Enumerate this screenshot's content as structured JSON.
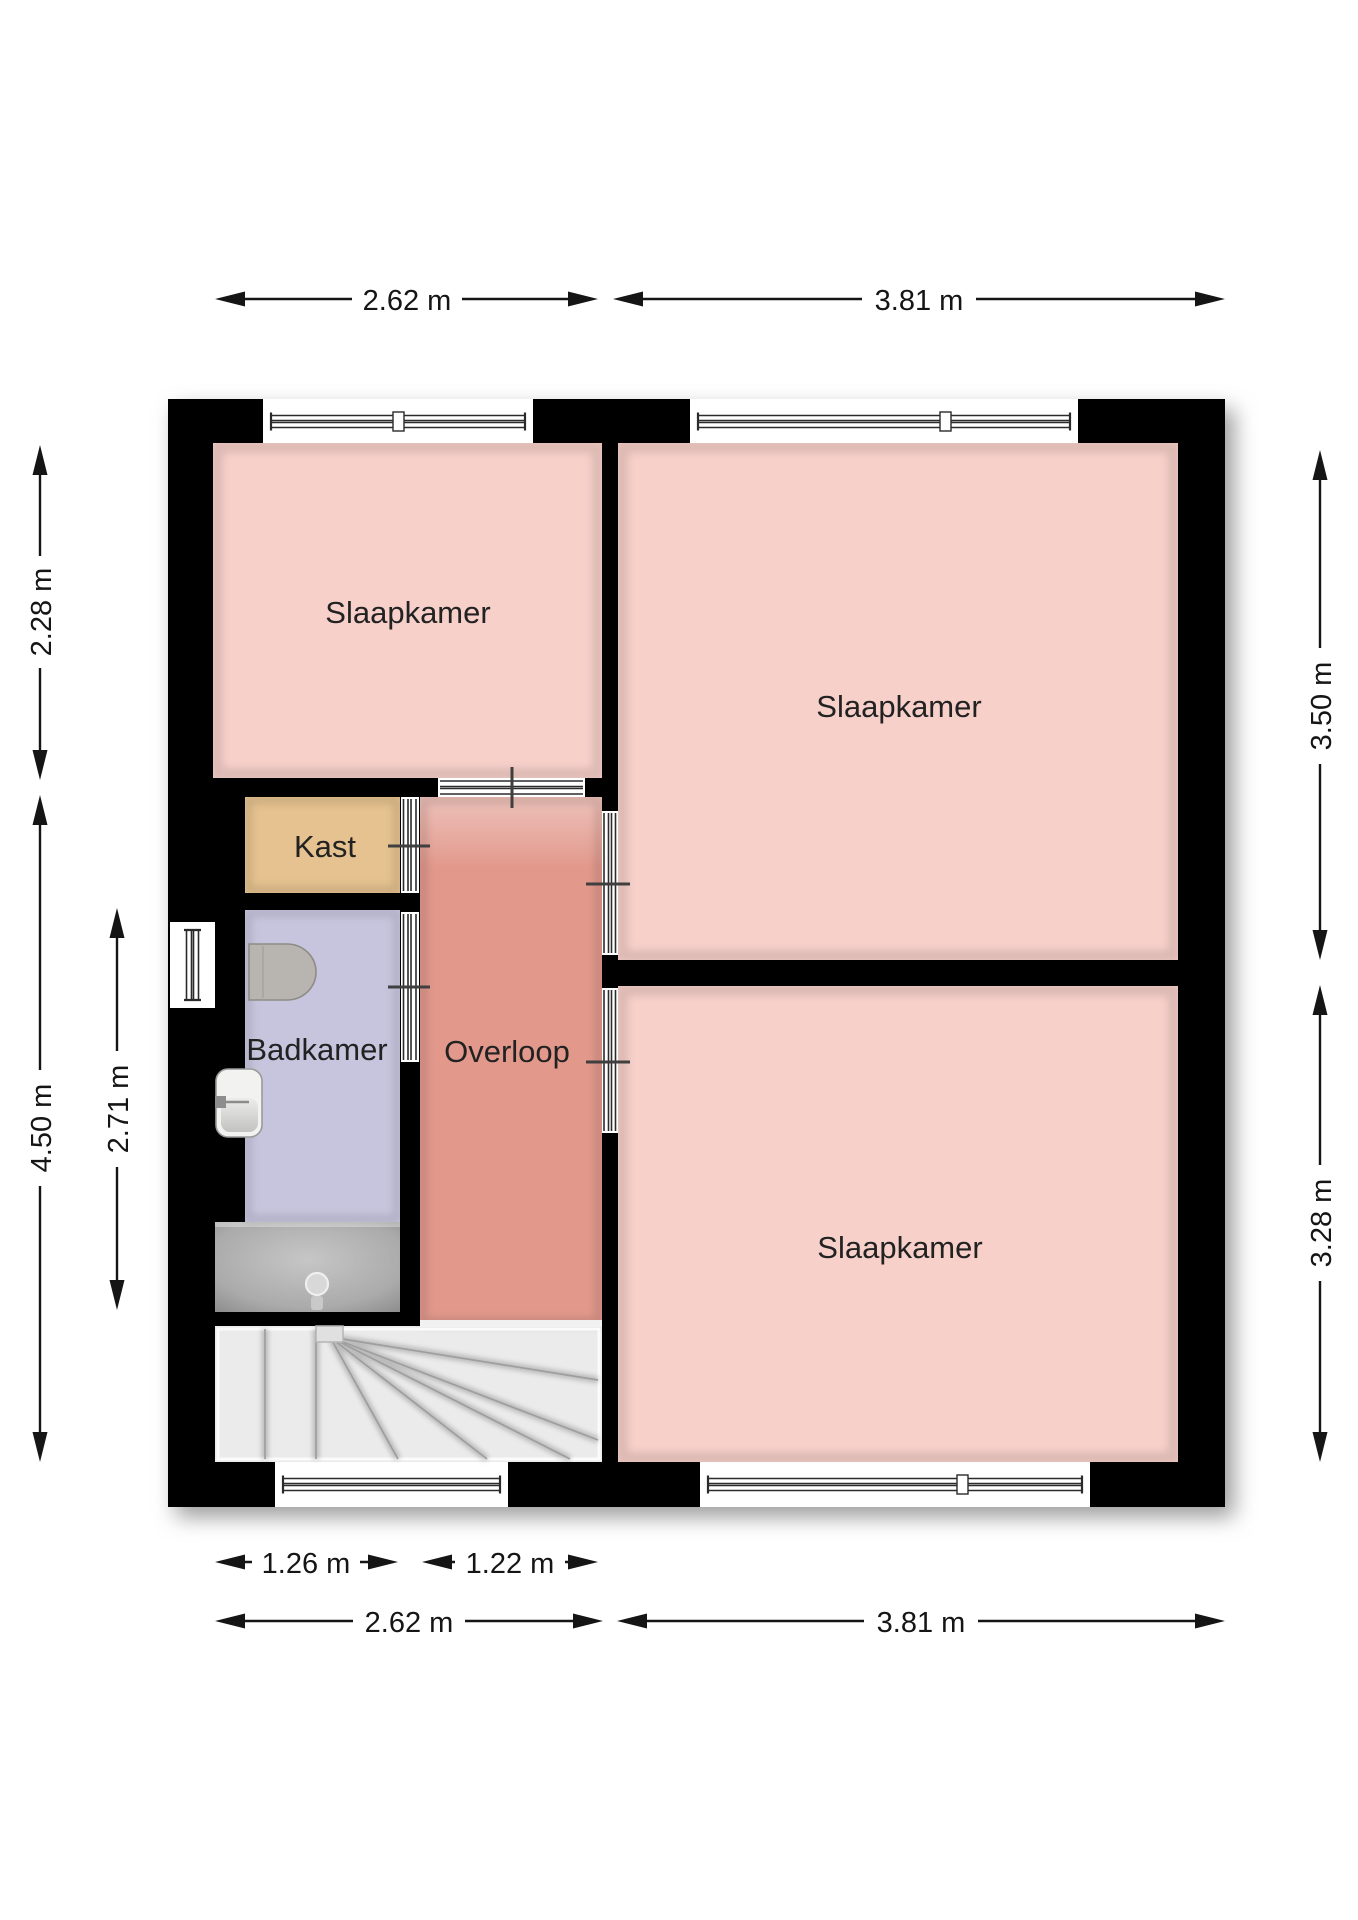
{
  "title": "Verdieping plattegrond",
  "colors": {
    "wall": "#000000",
    "bedroom": "#f8d0ca",
    "hallway": "#e2998c",
    "closet": "#e5c28f",
    "bathroom": "#c7c5dd",
    "stairs": "#ebebeb",
    "shower": "#ababab",
    "background": "#ffffff",
    "dimension_text": "#151515"
  },
  "rooms": [
    {
      "id": "slaapkamer-top-left",
      "label": "Slaapkamer"
    },
    {
      "id": "slaapkamer-top-right",
      "label": "Slaapkamer"
    },
    {
      "id": "slaapkamer-bottom-right",
      "label": "Slaapkamer"
    },
    {
      "id": "kast",
      "label": "Kast"
    },
    {
      "id": "badkamer",
      "label": "Badkamer"
    },
    {
      "id": "overloop",
      "label": "Overloop"
    }
  ],
  "fixtures": [
    "toilet",
    "washbasin",
    "shower-head",
    "staircase",
    "window",
    "door-opening"
  ],
  "dimensions": {
    "top_left": "2.62 m",
    "top_right": "3.81 m",
    "left_upper": "2.28 m",
    "left_full": "4.50 m",
    "left_inner": "2.71 m",
    "right_upper": "3.50 m",
    "right_lower": "3.28 m",
    "bottom_inner_left": "1.26 m",
    "bottom_inner_right": "1.22 m",
    "bottom_left": "2.62 m",
    "bottom_right": "3.81 m"
  }
}
